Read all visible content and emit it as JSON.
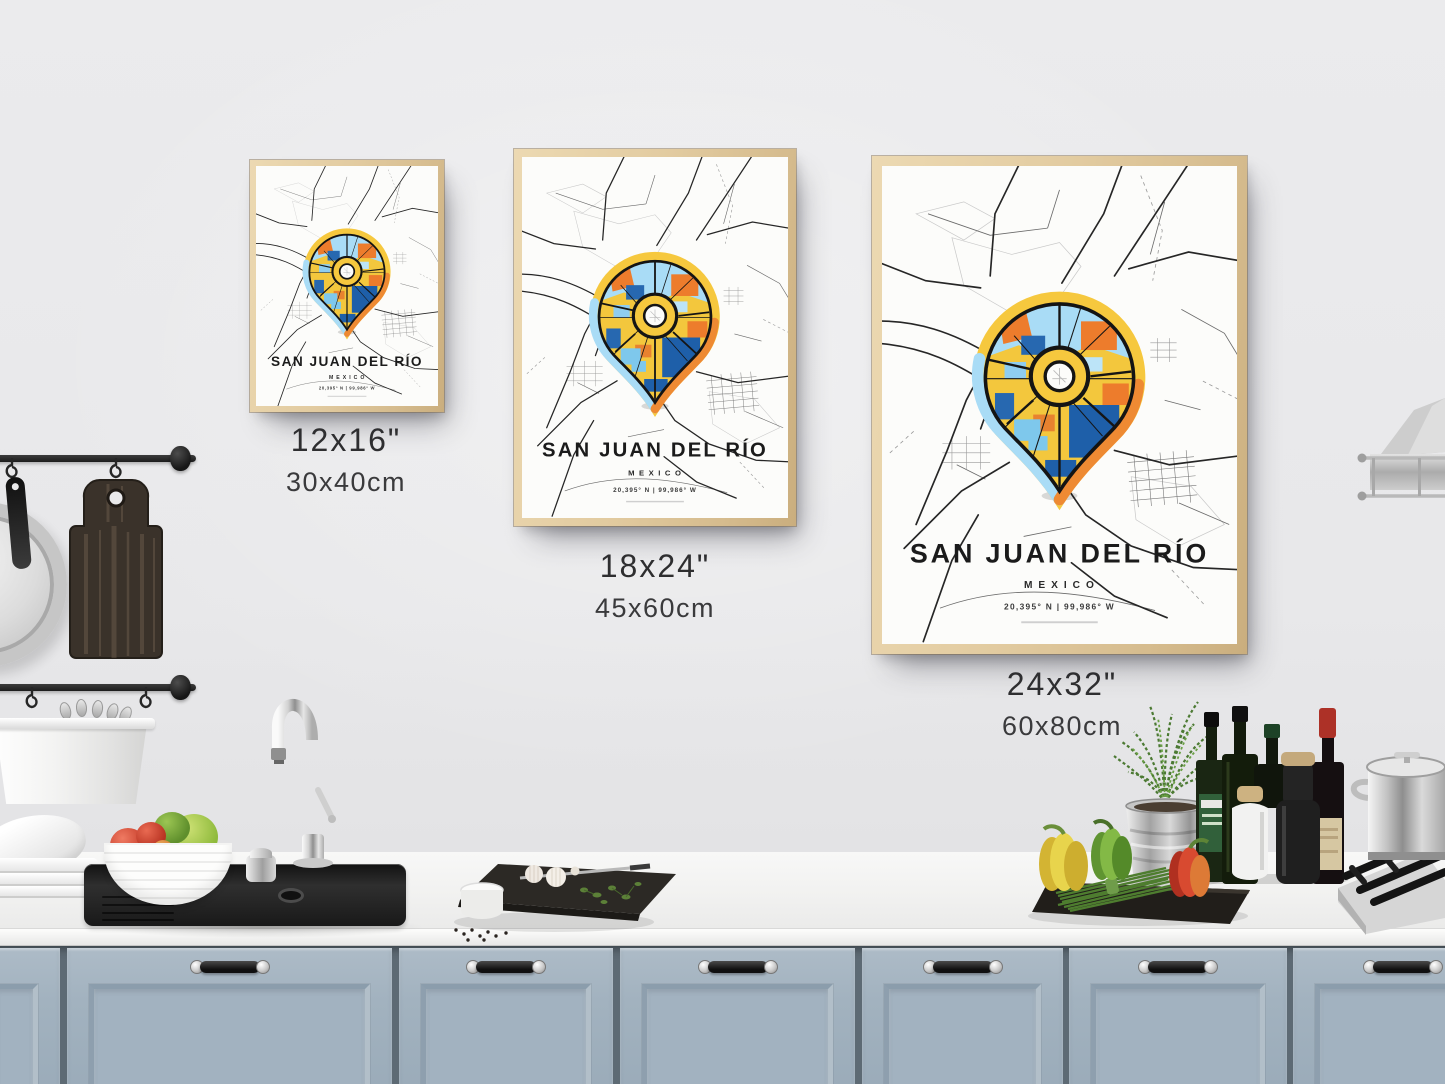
{
  "poster": {
    "title": "SAN JUAN DEL RÍO",
    "country": "MEXICO",
    "coordinates": "20,395° N | 99,986° W"
  },
  "size_labels": [
    {
      "inches": "12x16\"",
      "cm": "30x40cm"
    },
    {
      "inches": "18x24\"",
      "cm": "45x60cm"
    },
    {
      "inches": "24x32\"",
      "cm": "60x80cm"
    }
  ],
  "colors": {
    "pin_yellow": "#F6C83E",
    "pin_orange": "#EE7C2C",
    "pin_blue": "#1E5FA9",
    "pin_light_blue": "#A9DCF6",
    "map_road_black": "#262626",
    "frame_wood": "#E2CBA0",
    "cabinet_blue_gray": "#9FAFBC",
    "wall_gray": "#E8E8EA",
    "counter_white": "#F4F4F3"
  }
}
